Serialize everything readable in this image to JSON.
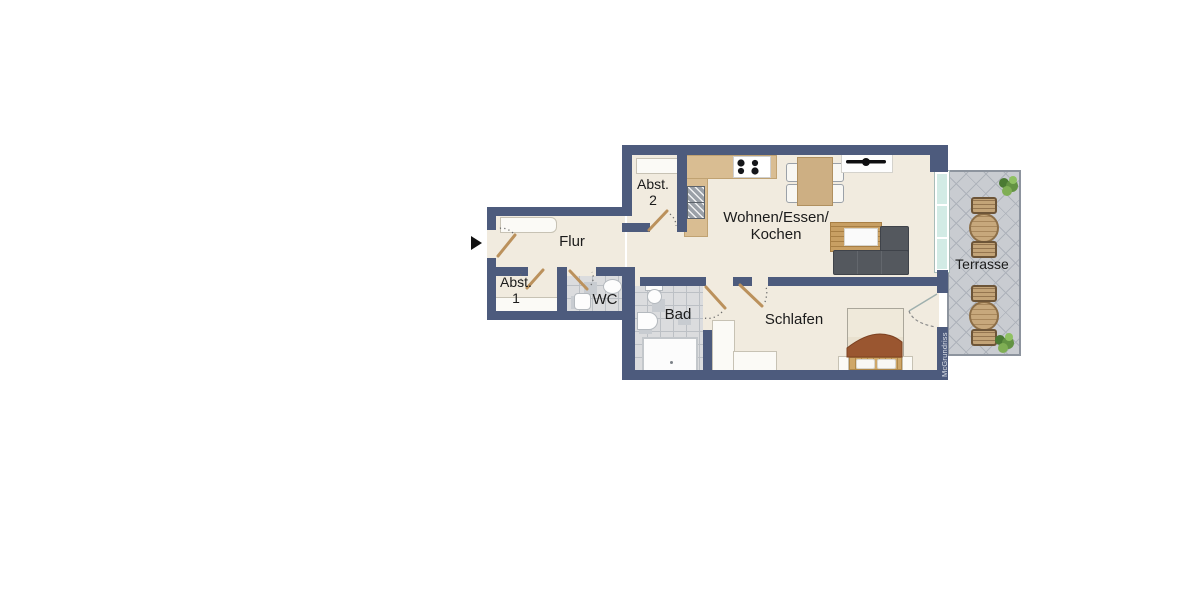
{
  "type": "apartment-floor-plan",
  "language": "de",
  "rooms": {
    "flur": {
      "label": "Flur"
    },
    "abst1": {
      "line1": "Abst.",
      "line2": "1"
    },
    "abst2": {
      "line1": "Abst.",
      "line2": "2"
    },
    "wc": {
      "label": "WC"
    },
    "bad": {
      "label": "Bad"
    },
    "wohnen": {
      "line1": "Wohnen/Essen/",
      "line2": "Kochen"
    },
    "schlafen": {
      "label": "Schlafen"
    },
    "terrasse": {
      "label": "Terrasse"
    }
  },
  "watermark": {
    "label": "McGrundriss"
  },
  "colors": {
    "wall": "#4d5b7d",
    "floor": "#f1ebdf",
    "bath_tile": "#dbdcde",
    "terrace_tile": "#c9ccd1",
    "window_glass": "#d2ebe5",
    "kitchen_counter": "#d9bd92",
    "wood": "#c89f63",
    "sofa": "#54585e",
    "blanket": "#9a5630",
    "door_leaf": "#bb915c",
    "plant": "#639343"
  },
  "furniture_icons": [
    "entrance-arrow",
    "flur-wardrobe",
    "shelf-abst1",
    "shelf-abst2",
    "kitchen-counter",
    "stove",
    "kitchen-sink-units",
    "dining-table",
    "dining-chairs",
    "tv-sideboard",
    "wood-console",
    "sofa",
    "wc-toilet",
    "wc-sink",
    "bath-toilet",
    "bath-sink",
    "shower",
    "double-bed",
    "nightstands",
    "wardrobes",
    "terrace-tables",
    "terrace-chairs",
    "plants"
  ]
}
